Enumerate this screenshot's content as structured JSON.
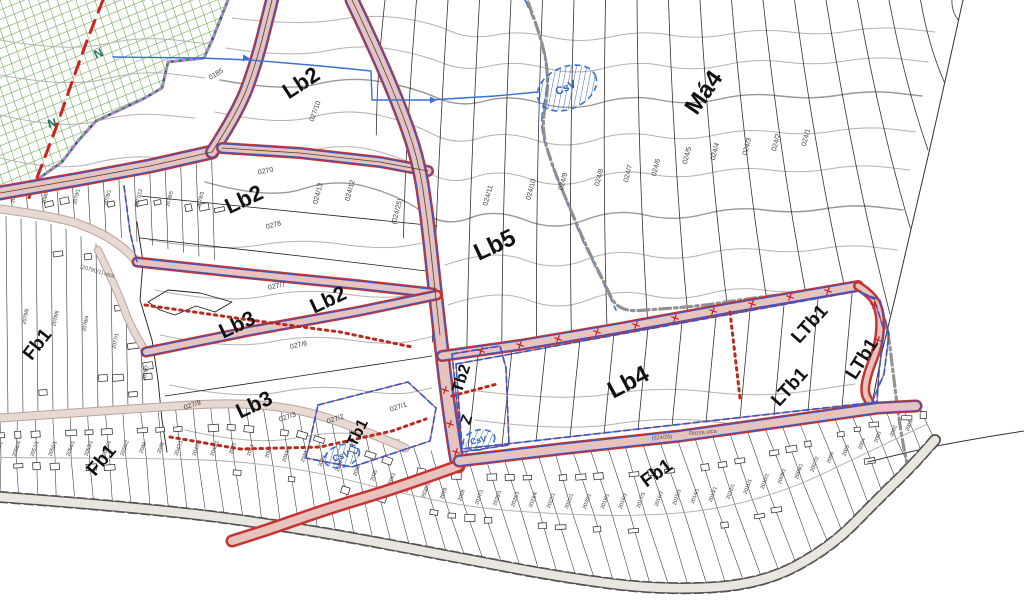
{
  "map": {
    "title": "settlement zoning plan map",
    "colors": {
      "bg": "#ffffff",
      "road_fill": "#e7c3be",
      "road_edge": "#c63330",
      "zone_blue": "#3a56c8",
      "dotted_red": "#b92b1e",
      "contour": "#b5b2ae",
      "contour_index": "#9a9794",
      "strip_black": "#1c1c1c",
      "green_hatch": "#67a04b",
      "teal_boundary": "#1f5f63",
      "purple_dots": "#b77fd6",
      "red_dash": "#cc2222",
      "water_blue": "#3a6fd8",
      "admin_gray": "#8c8c8c",
      "village_street_fill": "#e8d8d2",
      "village_street_edge": "#b9a49c",
      "main_road_gray_fill": "#e9e6e0",
      "main_road_gray_edge": "#55534e"
    },
    "zone_labels": [
      {
        "text": "Lb2",
        "x": 305,
        "y": 89,
        "rot": -33,
        "size": 22
      },
      {
        "text": "Lb2",
        "x": 247,
        "y": 206,
        "rot": -25,
        "size": 22
      },
      {
        "text": "Lb2",
        "x": 331,
        "y": 306,
        "rot": -25,
        "size": 21
      },
      {
        "text": "Lb3",
        "x": 240,
        "y": 331,
        "rot": -25,
        "size": 21
      },
      {
        "text": "Lb3",
        "x": 257,
        "y": 411,
        "rot": -25,
        "size": 21
      },
      {
        "text": "Lb5",
        "x": 498,
        "y": 252,
        "rot": -25,
        "size": 24
      },
      {
        "text": "Má4",
        "x": 710,
        "y": 97,
        "rot": -55,
        "size": 24
      },
      {
        "text": "Lb4",
        "x": 632,
        "y": 389,
        "rot": -28,
        "size": 24
      },
      {
        "text": "Tb2",
        "x": 466,
        "y": 380,
        "rot": -72,
        "size": 16
      },
      {
        "text": "Z",
        "x": 471,
        "y": 421,
        "rot": -72,
        "size": 15
      },
      {
        "text": "Tb1",
        "x": 362,
        "y": 435,
        "rot": -64,
        "size": 16
      },
      {
        "text": "LTb1",
        "x": 814,
        "y": 328,
        "rot": -48,
        "size": 19
      },
      {
        "text": "LTb1",
        "x": 794,
        "y": 391,
        "rot": -48,
        "size": 19
      },
      {
        "text": "LTb1",
        "x": 867,
        "y": 362,
        "rot": -58,
        "size": 19
      },
      {
        "text": "Fb1",
        "x": 42,
        "y": 348,
        "rot": -52,
        "size": 19
      },
      {
        "text": "Fb1",
        "x": 106,
        "y": 464,
        "rot": -50,
        "size": 19
      },
      {
        "text": "Fb1",
        "x": 660,
        "y": 478,
        "rot": -36,
        "size": 19
      }
    ],
    "water_labels": [
      {
        "text": "CsV",
        "x": 567,
        "y": 91,
        "rot": -24,
        "size": 11
      },
      {
        "text": "CsV",
        "x": 342,
        "y": 459,
        "rot": -18,
        "size": 9
      },
      {
        "text": "CsV",
        "x": 479,
        "y": 443,
        "rot": -12,
        "size": 8.5
      }
    ],
    "boundary_letters": [
      {
        "text": "N",
        "x": 100,
        "y": 57,
        "rot": -25,
        "size": 12
      },
      {
        "text": "N",
        "x": 53,
        "y": 127,
        "rot": -15,
        "size": 12
      }
    ],
    "parcel_labels": [
      {
        "text": "0185",
        "x": 217,
        "y": 76,
        "rot": -30
      },
      {
        "text": "027/10",
        "x": 317,
        "y": 112,
        "rot": -70
      },
      {
        "text": "0270",
        "x": 266,
        "y": 173,
        "rot": -12
      },
      {
        "text": "0278",
        "x": 274,
        "y": 227,
        "rot": -15
      },
      {
        "text": "027/7",
        "x": 277,
        "y": 288,
        "rot": -12
      },
      {
        "text": "027/6",
        "x": 299,
        "y": 347,
        "rot": -12
      },
      {
        "text": "027/9",
        "x": 193,
        "y": 407,
        "rot": -18
      },
      {
        "text": "027/3",
        "x": 288,
        "y": 419,
        "rot": -18
      },
      {
        "text": "027/2",
        "x": 336,
        "y": 421,
        "rot": -18
      },
      {
        "text": "027/1",
        "x": 399,
        "y": 409,
        "rot": -18
      },
      {
        "text": "(024/25)",
        "x": 399,
        "y": 212,
        "rot": -75
      },
      {
        "text": "024/13",
        "x": 320,
        "y": 194,
        "rot": -75
      },
      {
        "text": "024/12",
        "x": 352,
        "y": 191,
        "rot": -75
      },
      {
        "text": "024/11",
        "x": 490,
        "y": 196,
        "rot": -75
      },
      {
        "text": "024/10",
        "x": 533,
        "y": 190,
        "rot": -75
      },
      {
        "text": "024/9",
        "x": 565,
        "y": 182,
        "rot": -75
      },
      {
        "text": "024/8",
        "x": 601,
        "y": 178,
        "rot": -75
      },
      {
        "text": "024/7",
        "x": 630,
        "y": 174,
        "rot": -75
      },
      {
        "text": "024/6",
        "x": 658,
        "y": 168,
        "rot": -75
      },
      {
        "text": "024/5",
        "x": 689,
        "y": 156,
        "rot": -75
      },
      {
        "text": "024/4",
        "x": 717,
        "y": 152,
        "rot": -75
      },
      {
        "text": "024/3",
        "x": 749,
        "y": 147,
        "rot": -75
      },
      {
        "text": "024/2",
        "x": 778,
        "y": 143,
        "rot": -75
      },
      {
        "text": "024/1",
        "x": 808,
        "y": 138,
        "rot": -75
      }
    ],
    "street_labels": [
      {
        "text": "(024/26)",
        "x": 662,
        "y": 439,
        "rot": -5
      },
      {
        "text": "Rózsa utca",
        "x": 703,
        "y": 434,
        "rot": -5
      },
      {
        "text": "(20780/1) utca",
        "x": 97,
        "y": 273,
        "rot": 16
      }
    ],
    "village_parcels_block1": [
      "2081/1",
      "2080/1",
      "2079/1",
      "2078/1",
      "2077/12",
      "2078/5",
      "2078/3",
      "2079/3",
      "2078/6",
      "2076/3"
    ],
    "village_parcels_block2": [
      "2079/6",
      "2078/6",
      "2078/4",
      "2077/1",
      "2075/7",
      "2073/1",
      "2072/1",
      "2071/1",
      "2072/5",
      "2074/5"
    ],
    "village_parcels_bottom": [
      "2058/1",
      "2058/4",
      "2057/1",
      "2056/1",
      "2054/1",
      "2053/1",
      "2052/1",
      "2050/2",
      "2049",
      "2048",
      "2047/1",
      "2047/3",
      "2046/1",
      "2045",
      "2044",
      "2094",
      "2043/2",
      "2040",
      "2039",
      "2038",
      "2036",
      "2035",
      "2034/1",
      "2033/1",
      "2030/1",
      "2029",
      "2028",
      "2027/1",
      "2026/1",
      "2025/1",
      "2023/4",
      "2022/1",
      "2021/1",
      "2020/1",
      "2019/1",
      "2018/3",
      "2017/3",
      "2016/2",
      "2015/3",
      "2014/1",
      "2013/1",
      "2012/1",
      "2011/1",
      "2010/2",
      "2009/1",
      "2008/1",
      "2007/2",
      "2006",
      "2005",
      "2004",
      "2003",
      "2002",
      "2001"
    ]
  }
}
